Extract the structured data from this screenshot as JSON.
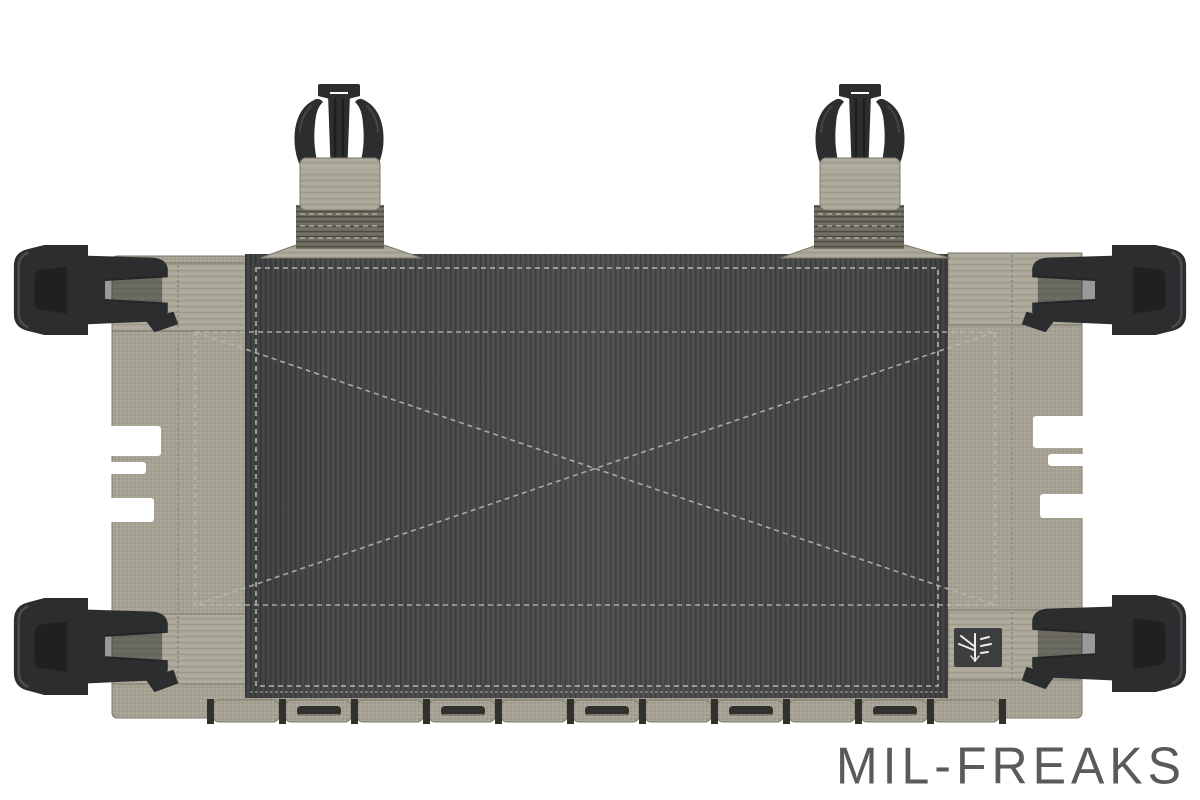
{
  "image": {
    "subject": "Ranger-green chest rig base panel with charcoal loop-velcro front, laser-cut MOLLE bottom row, four side-release corner buckles, two top male buckle straps and a small woven brand tag",
    "width": 1200,
    "height": 800
  },
  "watermark": {
    "text": "MIL-FREAKS"
  },
  "tag": {
    "logo_icon": "insect-emblem"
  },
  "colors": {
    "background": "#ffffff",
    "fabric": "#a6a294",
    "fabric_hi": "#b6b2a3",
    "fabric_lo": "#8f8c7d",
    "fabric_dark": "#7a7868",
    "webbing_base": "#aca89a",
    "webbing_dark": "#6b695e",
    "velcro": "#48494b",
    "velcro_rib": "#3a3b3d",
    "velcro_light": "#5b5d5f",
    "buckle": "#2c2d2f",
    "buckle_dark": "#1b1c1d",
    "buckle_hi": "#54575a",
    "stitch_light": "#b9b6a6",
    "stitch_olive": "#8f8d7d",
    "slot_dark": "#30302c",
    "tag_bg": "#3d3e40",
    "tag_fg": "#eceeea",
    "watermark": "#595a5c"
  }
}
